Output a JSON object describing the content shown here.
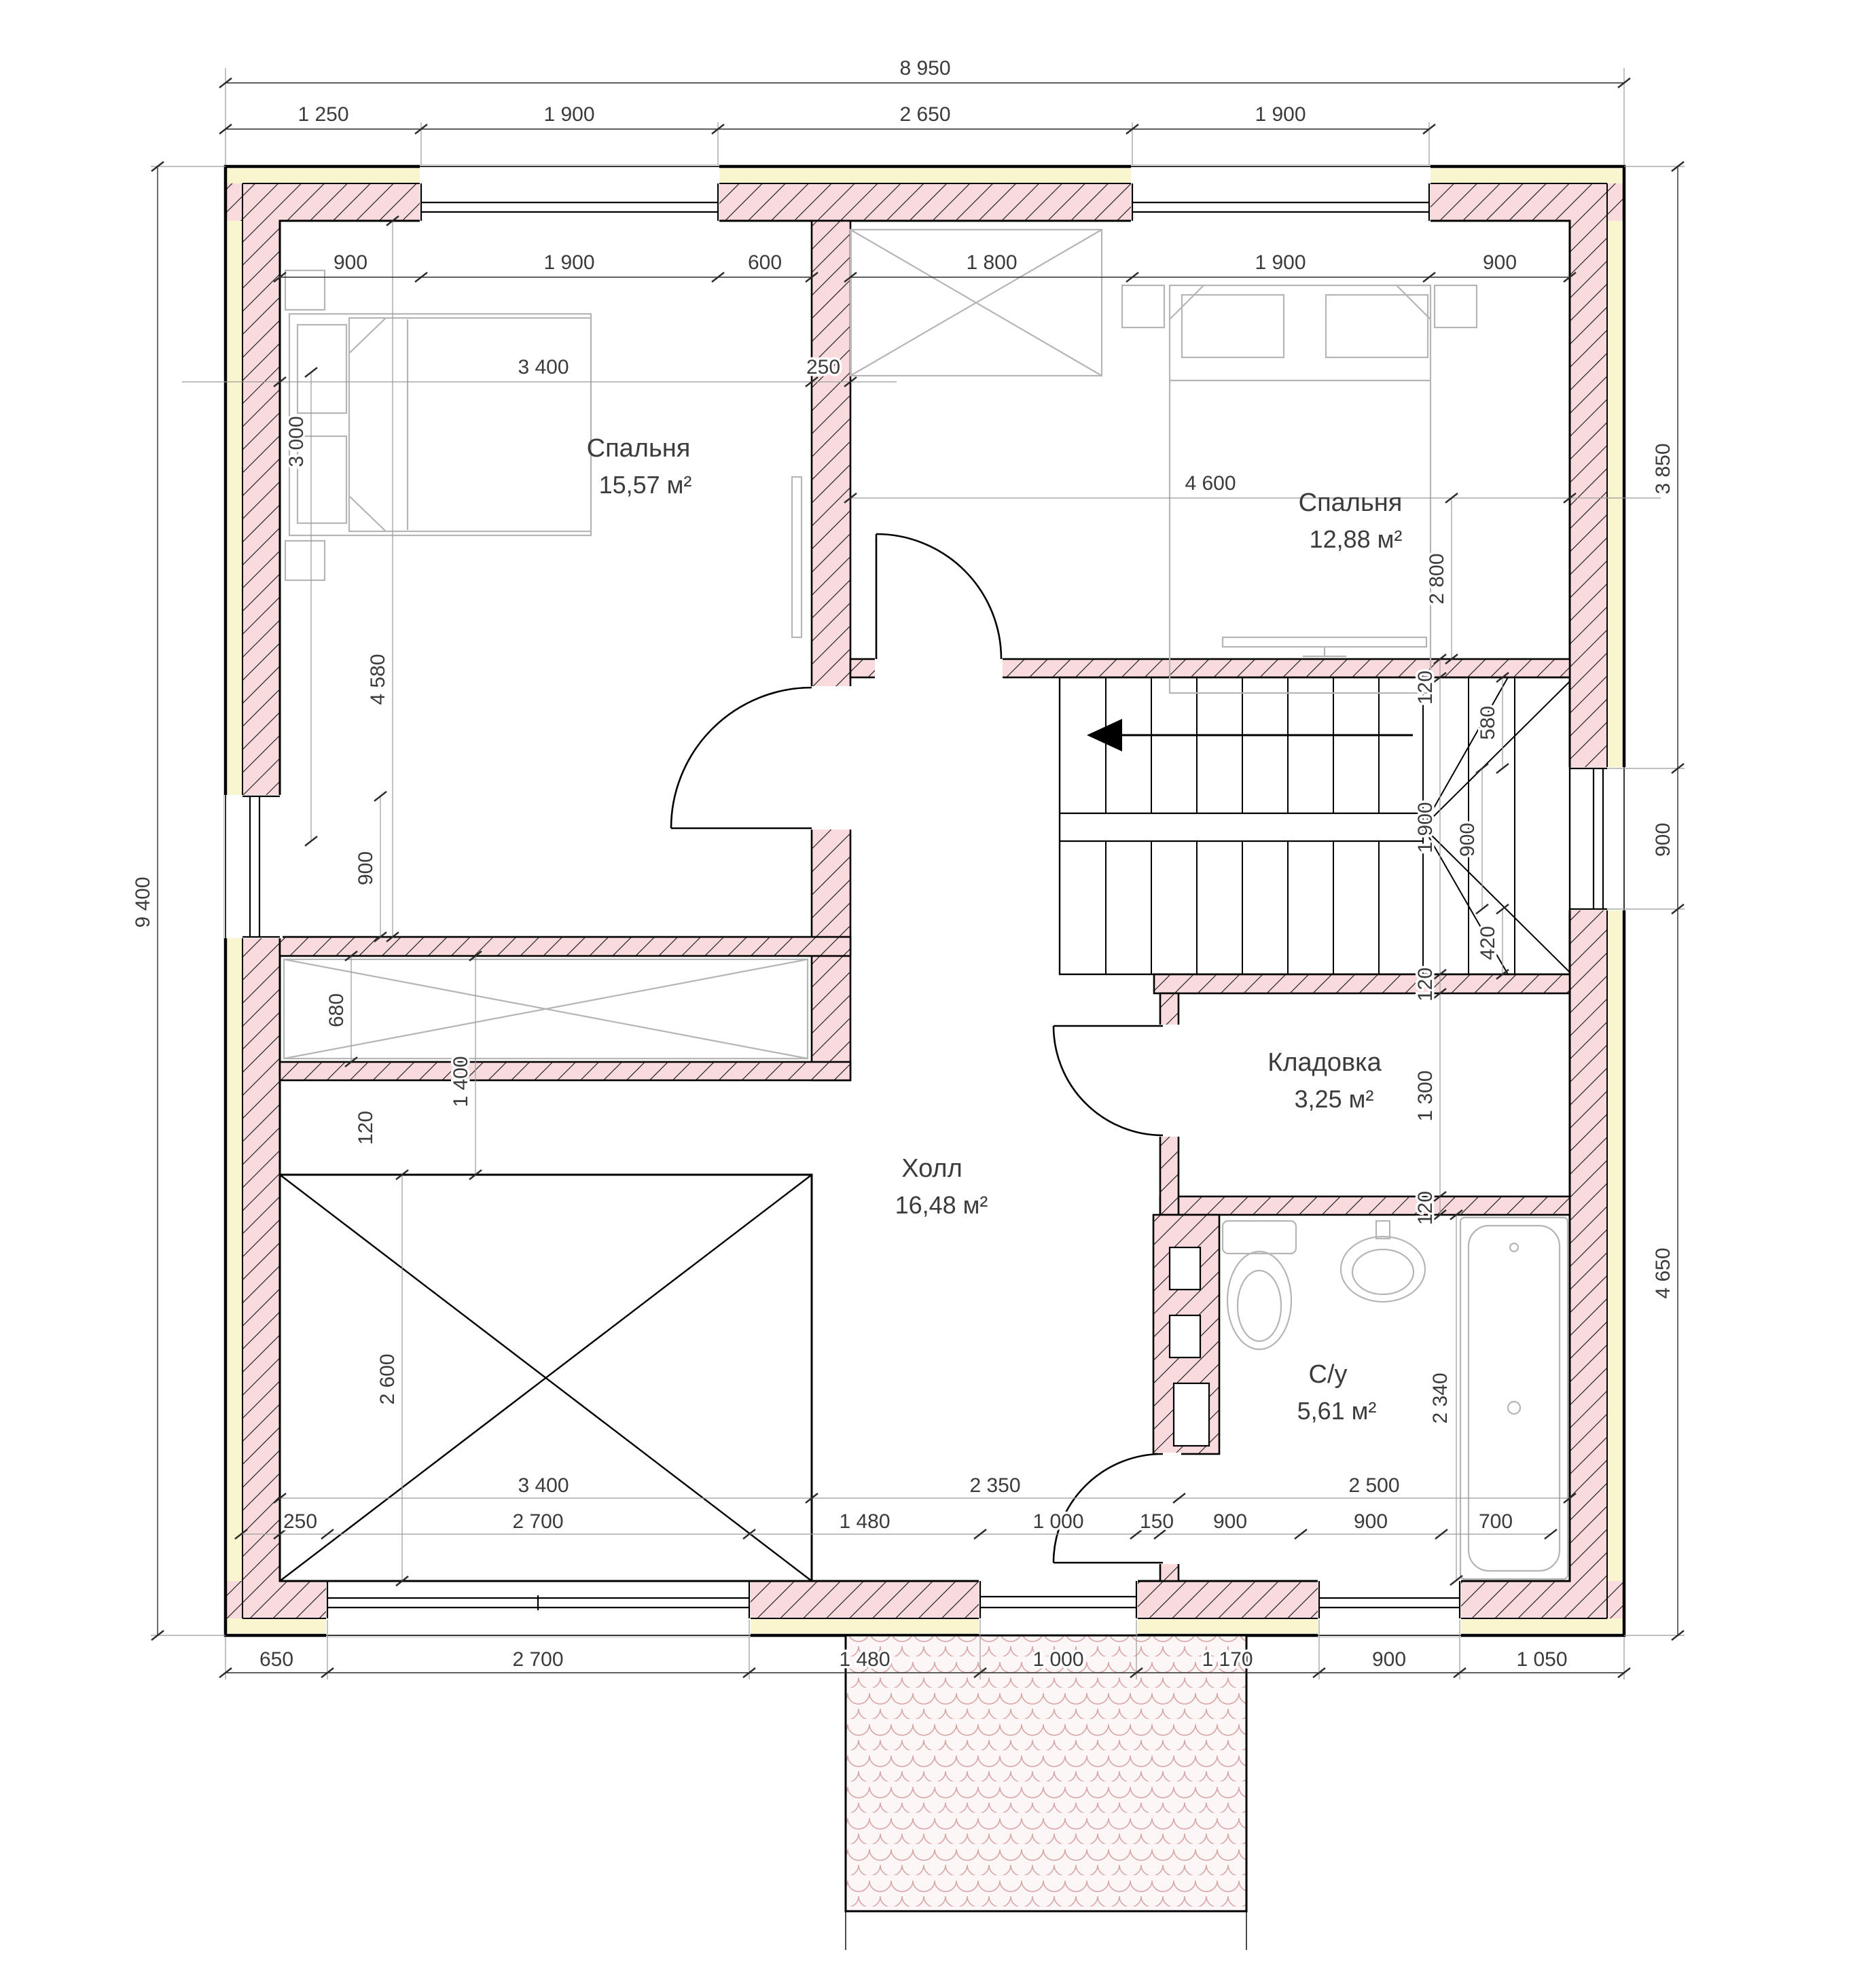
{
  "drawing_type": "floor-plan",
  "language": "ru",
  "colors": {
    "wall_masonry_fill": "#f9dadd",
    "insulation_fill": "#f8f5cf",
    "outline": "#000000",
    "furniture_gray": "#b5b5b5",
    "dimension_text": "#3b3b3b",
    "roof_tile": "#d9a6a6"
  },
  "rooms": {
    "bedroom1": {
      "name": "Спальня",
      "area": "15,57 м²"
    },
    "bedroom2": {
      "name": "Спальня",
      "area": "12,88 м²"
    },
    "hall": {
      "name": "Холл",
      "area": "16,48 м²"
    },
    "storage": {
      "name": "Кладовка",
      "area": "3,25 м²"
    },
    "bathroom": {
      "name": "С/у",
      "area": "5,61 м²"
    }
  },
  "dims": {
    "total_width": "8 950",
    "total_height": "9 400",
    "top": [
      "1 250",
      "1 900",
      "2 650",
      "1 900"
    ],
    "top_in_left": [
      "900",
      "1 900",
      "600"
    ],
    "top_in_right": [
      "1 800",
      "1 900",
      "900"
    ],
    "mid": [
      "3 400",
      "250",
      "4 600"
    ],
    "b2_depth": "2 800",
    "left_in": {
      "bed": "3 000",
      "room": "4 580",
      "window": "900",
      "niche": "680",
      "wall": "120",
      "gap": "1 400",
      "void": "2 600"
    },
    "right": [
      "3 850",
      "900",
      "4 650"
    ],
    "stair": {
      "wall_top": "120",
      "above_win": "580",
      "run": "1 900",
      "window": "900",
      "below_win": "420",
      "wall_bottom": "120"
    },
    "storage_col": {
      "interior": "1 300",
      "wall": "120"
    },
    "bath": {
      "tub": "2 340"
    },
    "bottom_in1": [
      "3 400",
      "2 350",
      "2 500"
    ],
    "bottom_in2": [
      "250",
      "2 700",
      "1 480",
      "1 000",
      "150",
      "900",
      "900",
      "700"
    ],
    "bottom": [
      "650",
      "2 700",
      "1 480",
      "1 000",
      "1 170",
      "900",
      "1 050"
    ]
  }
}
